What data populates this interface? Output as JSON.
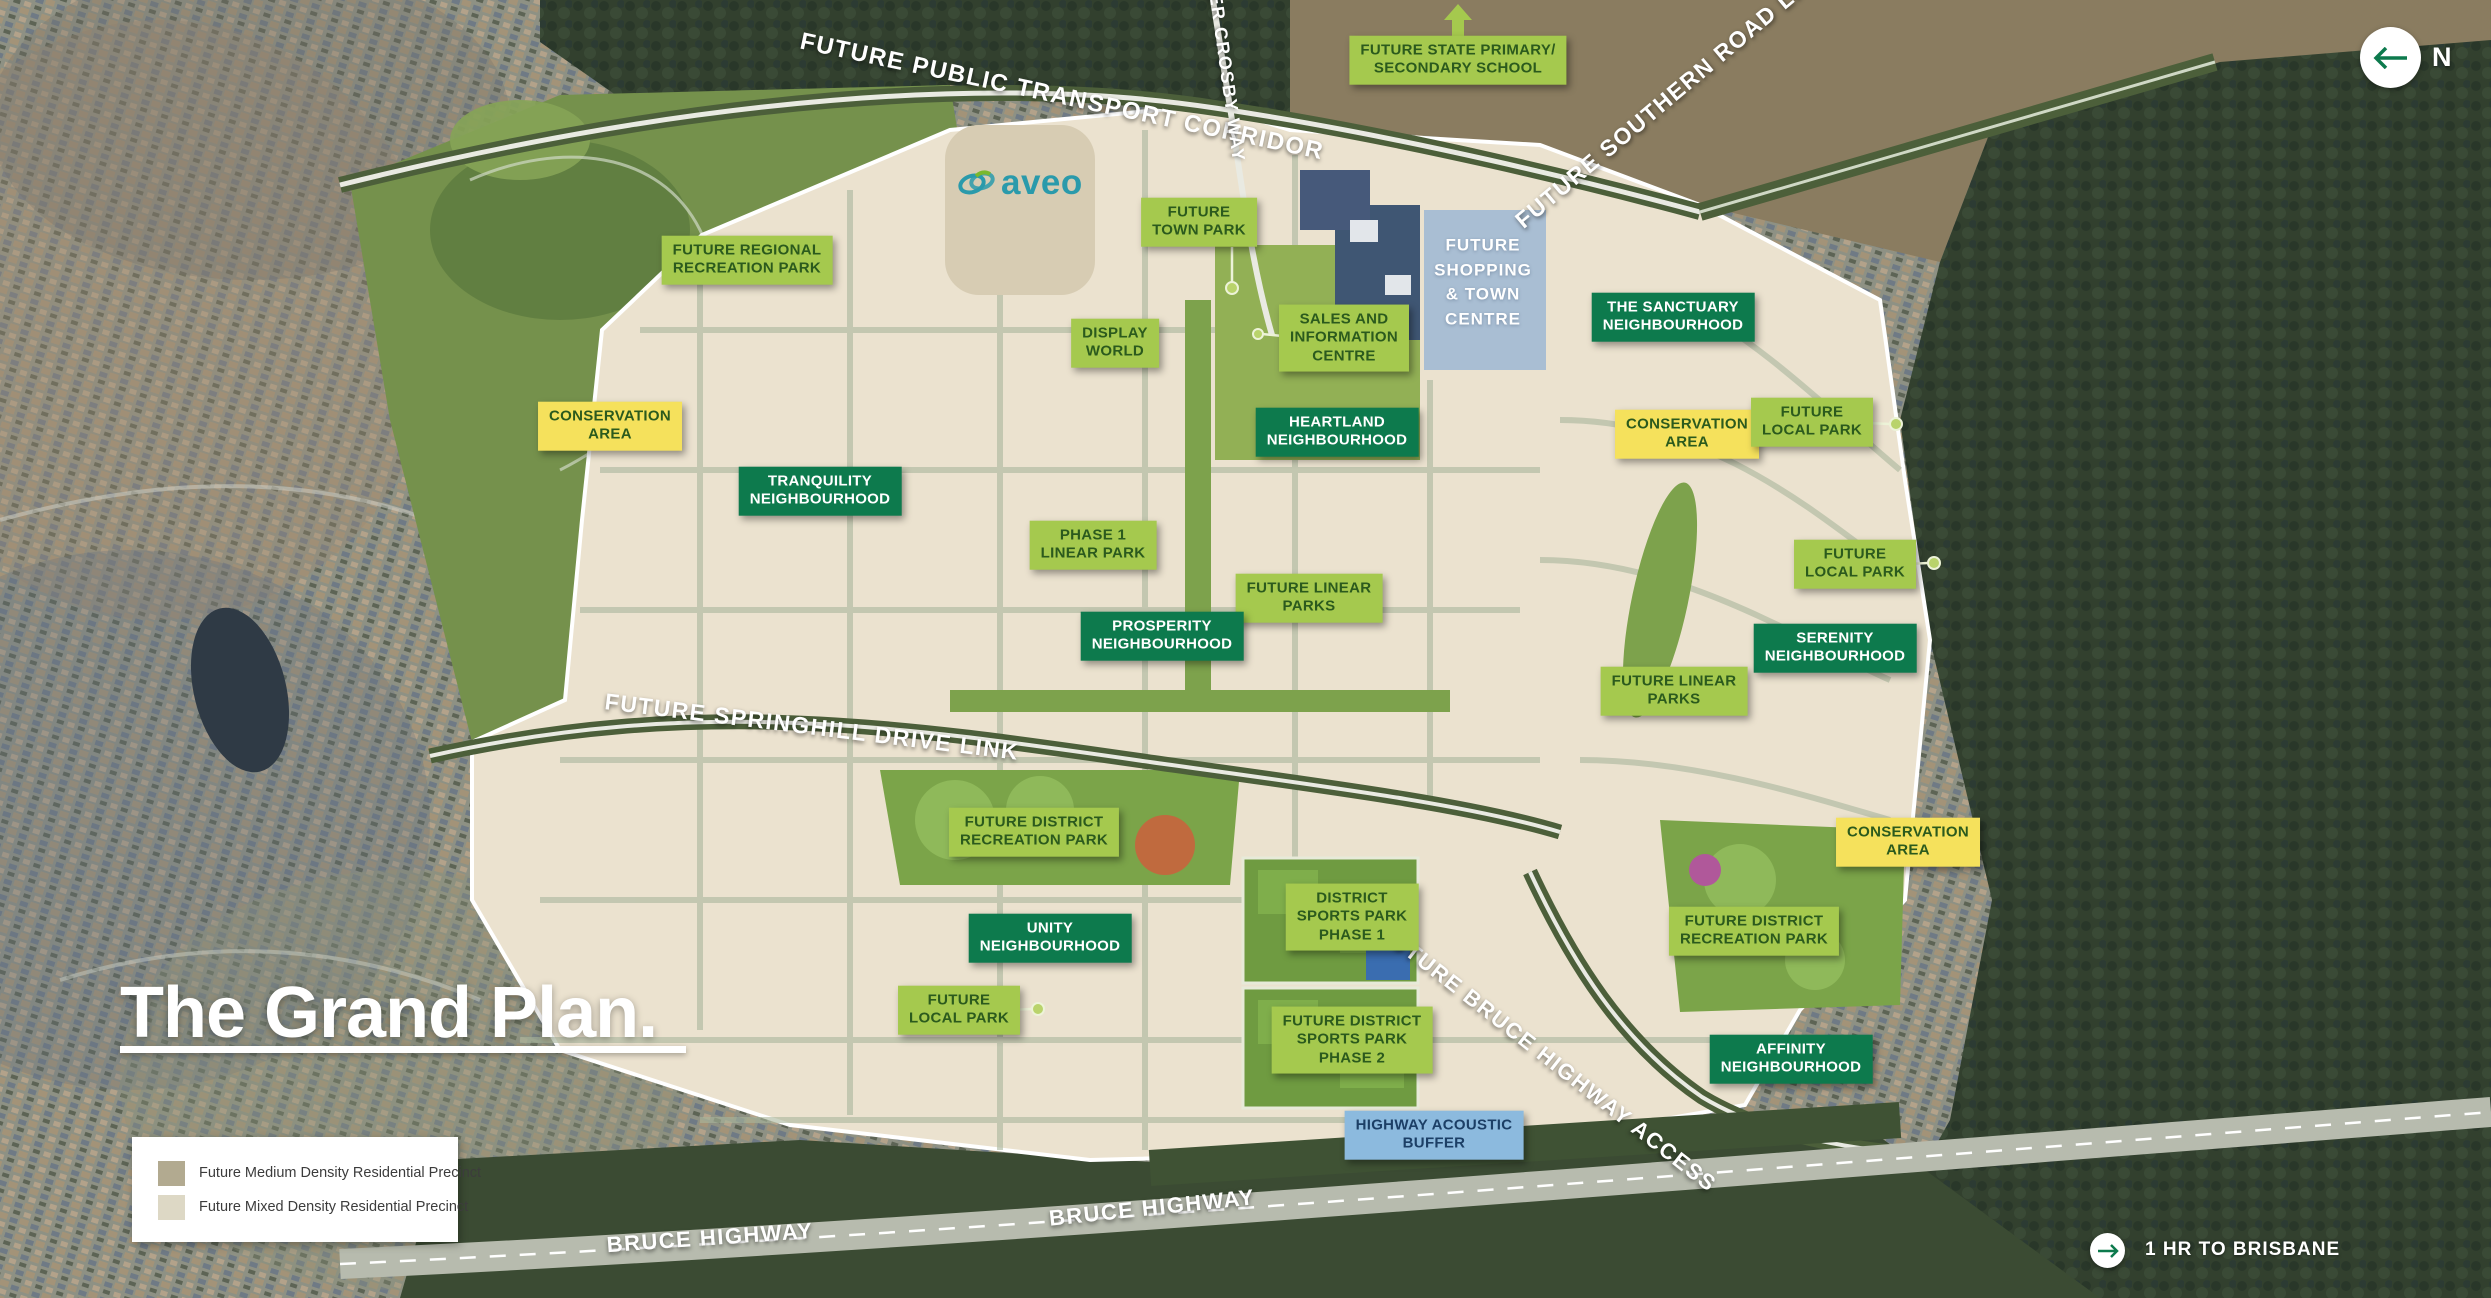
{
  "title": {
    "text": "The Grand Plan."
  },
  "brand": {
    "wordmark": "aveo"
  },
  "compass": {
    "north_label": "N"
  },
  "travel": {
    "text": "1 HR TO BRISBANE"
  },
  "legend": {
    "items": [
      {
        "label": "Future Medium Density Residential Precinct",
        "color": "#b2aa90"
      },
      {
        "label": "Future Mixed Density Residential Precinct",
        "color": "#ddd8c5"
      }
    ]
  },
  "colors": {
    "park_label": "#a5c94e",
    "neighbourhood_label": "#0d7a4d",
    "conservation_label": "#f5e15c",
    "buffer_label": "#8cbade",
    "road_text": "#ffffff",
    "brand_teal": "#2a9aab"
  },
  "labels": [
    {
      "name": "future-state-primary-secondary-school",
      "text": "FUTURE STATE PRIMARY/\nSECONDARY SCHOOL",
      "type": "park"
    },
    {
      "name": "future-regional-recreation-park",
      "text": "FUTURE REGIONAL\nRECREATION PARK",
      "type": "park"
    },
    {
      "name": "future-town-park",
      "text": "FUTURE\nTOWN PARK",
      "type": "park"
    },
    {
      "name": "display-world",
      "text": "DISPLAY\nWORLD",
      "type": "park"
    },
    {
      "name": "sales-and-information-centre",
      "text": "SALES AND\nINFORMATION\nCENTRE",
      "type": "park"
    },
    {
      "name": "future-shopping-town-centre",
      "text": "FUTURE\nSHOPPING\n& TOWN\nCENTRE",
      "type": "shopping"
    },
    {
      "name": "heartland-neighbourhood",
      "text": "HEARTLAND\nNEIGHBOURHOOD",
      "type": "nbhd"
    },
    {
      "name": "the-sanctuary-neighbourhood",
      "text": "THE SANCTUARY\nNEIGHBOURHOOD",
      "type": "nbhd"
    },
    {
      "name": "conservation-area-east",
      "text": "CONSERVATION\nAREA",
      "type": "conservation"
    },
    {
      "name": "future-local-park-sanctuary",
      "text": "FUTURE\nLOCAL PARK",
      "type": "park"
    },
    {
      "name": "conservation-area-west",
      "text": "CONSERVATION\nAREA",
      "type": "conservation"
    },
    {
      "name": "tranquility-neighbourhood",
      "text": "TRANQUILITY\nNEIGHBOURHOOD",
      "type": "nbhd"
    },
    {
      "name": "phase-1-linear-park",
      "text": "PHASE 1\nLINEAR PARK",
      "type": "park"
    },
    {
      "name": "future-linear-parks-central",
      "text": "FUTURE LINEAR\nPARKS",
      "type": "park"
    },
    {
      "name": "prosperity-neighbourhood",
      "text": "PROSPERITY\nNEIGHBOURHOOD",
      "type": "nbhd"
    },
    {
      "name": "future-local-park-serenity",
      "text": "FUTURE\nLOCAL PARK",
      "type": "park"
    },
    {
      "name": "serenity-neighbourhood",
      "text": "SERENITY\nNEIGHBOURHOOD",
      "type": "nbhd"
    },
    {
      "name": "future-linear-parks-east",
      "text": "FUTURE LINEAR\nPARKS",
      "type": "park"
    },
    {
      "name": "conservation-area-south",
      "text": "CONSERVATION\nAREA",
      "type": "conservation"
    },
    {
      "name": "future-district-recreation-park-west",
      "text": "FUTURE DISTRICT\nRECREATION PARK",
      "type": "park"
    },
    {
      "name": "unity-neighbourhood",
      "text": "UNITY\nNEIGHBOURHOOD",
      "type": "nbhd"
    },
    {
      "name": "future-local-park-unity",
      "text": "FUTURE\nLOCAL PARK",
      "type": "park"
    },
    {
      "name": "district-sports-park-phase-1",
      "text": "DISTRICT\nSPORTS PARK\nPHASE 1",
      "type": "park"
    },
    {
      "name": "future-district-sports-park-phase-2",
      "text": "FUTURE DISTRICT\nSPORTS PARK\nPHASE 2",
      "type": "park"
    },
    {
      "name": "future-district-recreation-park-east",
      "text": "FUTURE DISTRICT\nRECREATION PARK",
      "type": "park"
    },
    {
      "name": "affinity-neighbourhood",
      "text": "AFFINITY\nNEIGHBOURHOOD",
      "type": "nbhd"
    },
    {
      "name": "highway-acoustic-buffer",
      "text": "HIGHWAY ACOUSTIC\nBUFFER",
      "type": "buffer"
    }
  ],
  "roads": [
    {
      "name": "future-public-transport-corridor",
      "text": "FUTURE PUBLIC TRANSPORT CORRIDOR"
    },
    {
      "name": "peter-crosby-way",
      "text": "PETER CROSBY WAY"
    },
    {
      "name": "future-southern-road-link",
      "text": "FUTURE SOUTHERN ROAD LINK"
    },
    {
      "name": "future-springhill-drive-link",
      "text": "FUTURE SPRINGHILL DRIVE LINK"
    },
    {
      "name": "future-bruce-highway-access",
      "text": "FUTURE BRUCE HIGHWAY ACCESS"
    },
    {
      "name": "bruce-highway-west",
      "text": "BRUCE HIGHWAY"
    },
    {
      "name": "bruce-highway-east",
      "text": "BRUCE HIGHWAY"
    }
  ]
}
